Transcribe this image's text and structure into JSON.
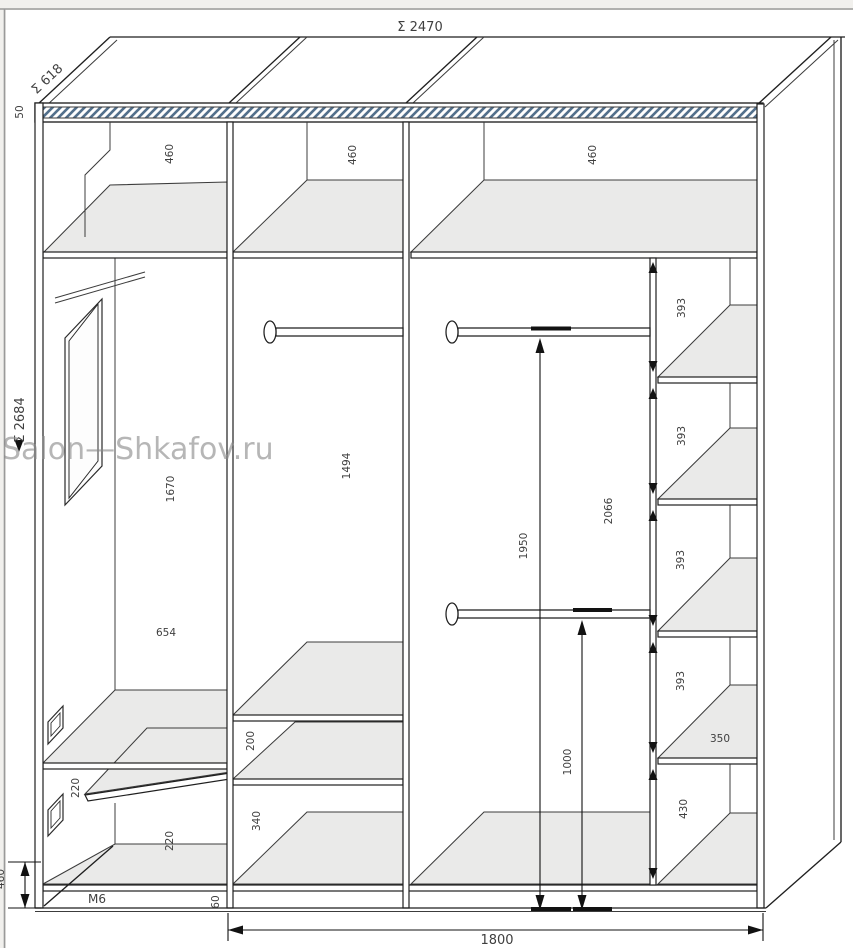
{
  "watermark": {
    "text": "Salon—Shkafov.ru"
  },
  "dimensions": {
    "total_width": "Σ 2470",
    "side_depth": "Σ 618",
    "total_height": "Σ 2684",
    "top_panel": "50",
    "top_gap_left": "460",
    "top_gap_mid": "460",
    "top_gap_right": "460",
    "left_upper": "1670",
    "left_width": "654",
    "left_shelf_gap_upper": "220",
    "left_shelf_gap_lower": "220",
    "left_edge_partial": "460",
    "marking": "M6",
    "mid_hang": "1494",
    "mid_gap_upper": "200",
    "mid_gap_lower": "340",
    "rod_upper_height": "1950",
    "rod_lower_height": "1000",
    "interior_height": "2066",
    "shelf_gap_1": "393",
    "shelf_gap_2": "393",
    "shelf_gap_3": "393",
    "shelf_gap_4": "393",
    "shelf_depth": "350",
    "bottom_gap": "430",
    "plinth": "60",
    "base_width": "1800"
  },
  "colors": {
    "background": "#f1f0ed",
    "line": "#1f1f1f",
    "hatch": "#53708c",
    "shelf_fill": "#eaeae9",
    "watermark": "#8a8a8a",
    "text": "#3f3f3f"
  }
}
